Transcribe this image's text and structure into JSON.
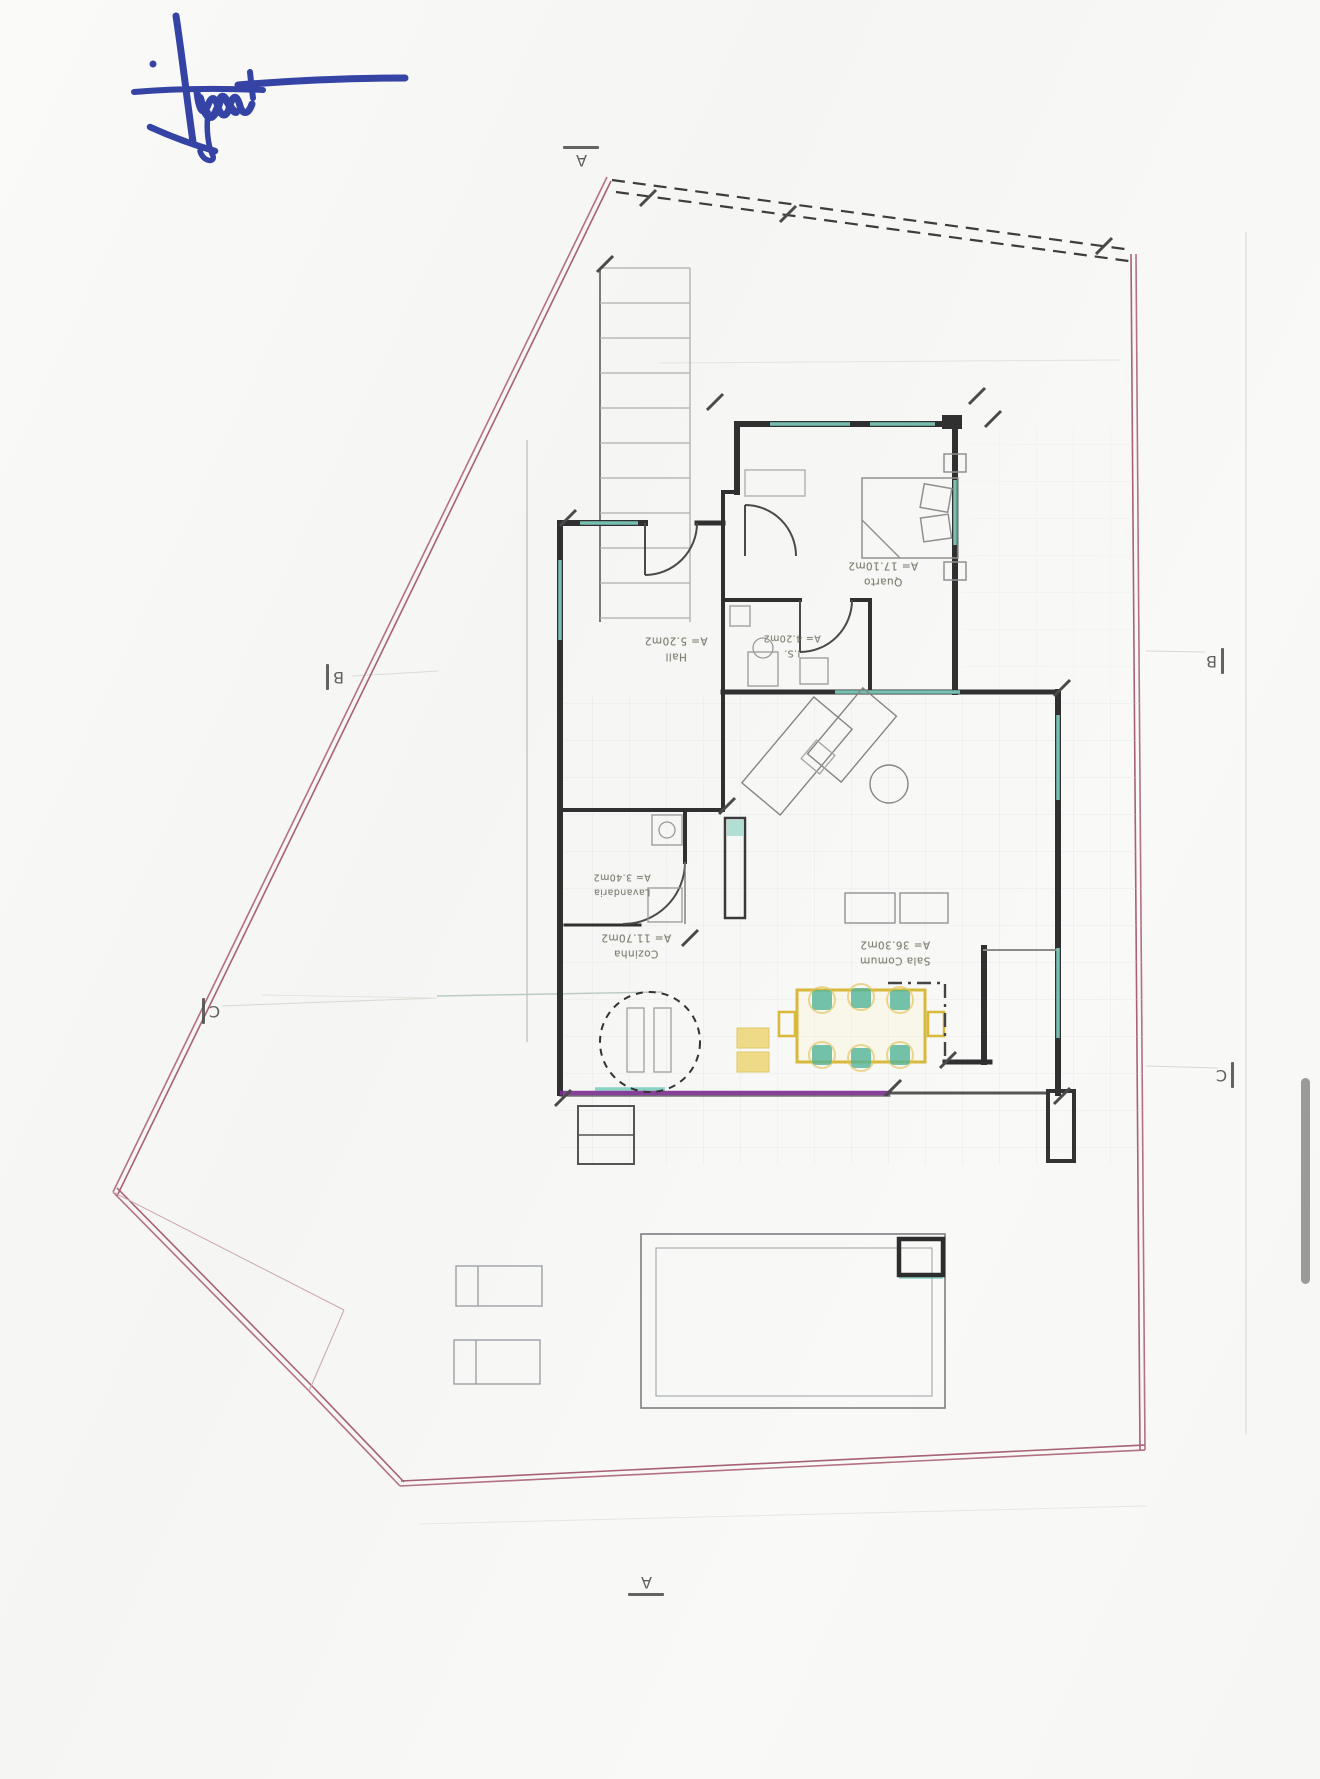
{
  "document": {
    "signature_icon": "handwritten-blue-ink-signature"
  },
  "section_markers": {
    "top": "A",
    "bottom": "A",
    "left_upper": "B",
    "right_upper": "B",
    "left_lower": "C",
    "right_lower": "C"
  },
  "rooms": [
    {
      "name": "Quarto",
      "area": "A= 17.10m2"
    },
    {
      "name": "Hall",
      "area": "A= 5.20m2"
    },
    {
      "name": "I.S.",
      "area": "A= 4.20m2"
    },
    {
      "name": "Lavandaria",
      "area": "A= 3.40m2"
    },
    {
      "name": "Cozinha",
      "area": "A= 11.70m2"
    },
    {
      "name": "Sala Comum",
      "area": "A= 36.30m2"
    }
  ],
  "colors": {
    "boundary_pink": "#b06a7c",
    "wall_dark": "#303030",
    "window_teal": "#7ecfc0",
    "highlight_magenta": "#7b2d91",
    "highlight_yellow": "#e6c94f",
    "chair_green": "#52b49a",
    "signature_blue": "#2b3aa0",
    "scrollbar_gray": "#8f8f8f"
  }
}
